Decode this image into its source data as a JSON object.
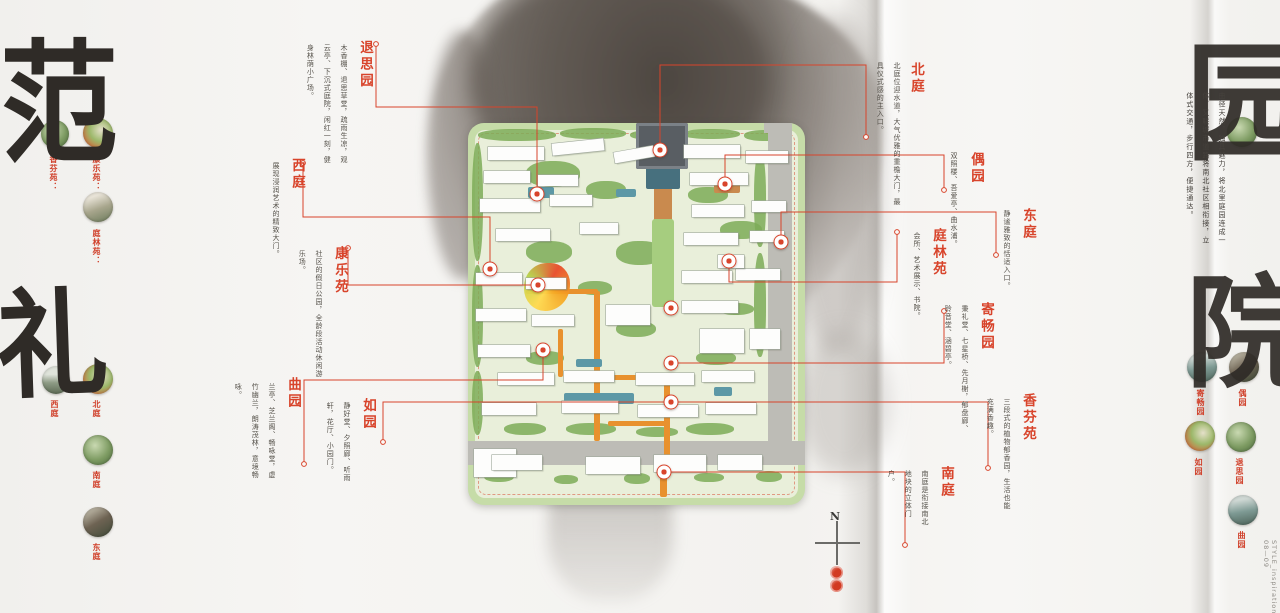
{
  "accent_red": "#d8442b",
  "calligraphy": {
    "top_left": "范",
    "bottom_left": "礼",
    "top_right": "园",
    "bottom_right": "院"
  },
  "right_paragraph": "曲径天然，独具魅力，将北里庭园连成一体，又联城市道路将南北社区相衔接，立体式交通，步行四方，便捷通达。",
  "compass": {
    "label": "N"
  },
  "footer": {
    "brand": "STYLE_inspiration",
    "page_no": "08—09"
  },
  "callouts": [
    {
      "id": "tuisiyuan",
      "title": "退思园",
      "desc": "木香棚、退思草堂，疏雨生凉，观云亭、下沉式庭院，闲红一刻，健身林荫小广场。",
      "title_pos": [
        355,
        40
      ],
      "desc_box": [
        352,
        44,
        120
      ],
      "line": [
        [
          376,
          44
        ],
        [
          376,
          107
        ],
        [
          537,
          107
        ],
        [
          537,
          194
        ]
      ],
      "marker": [
        537,
        194
      ]
    },
    {
      "id": "beiting",
      "title": "北庭",
      "desc": "北庭位迎水道，大气优雅的重檐大门，最具仪式感的主入口。",
      "title_pos": [
        906,
        62
      ],
      "desc_box": [
        905,
        62,
        150
      ],
      "line": [
        [
          866,
          137
        ],
        [
          866,
          65
        ],
        [
          660,
          65
        ],
        [
          660,
          150
        ]
      ],
      "marker": [
        660,
        150
      ]
    },
    {
      "id": "ouyuan",
      "title": "偶园",
      "desc": "双照楼、吾爱亭、曲水浦。",
      "title_pos": [
        966,
        152
      ],
      "desc_box": [
        962,
        152,
        100
      ],
      "line": [
        [
          944,
          190
        ],
        [
          944,
          155
        ],
        [
          725,
          155
        ],
        [
          725,
          184
        ]
      ],
      "marker": [
        725,
        184
      ]
    },
    {
      "id": "dongting",
      "title": "东庭",
      "desc": "静谧雅致的恬适入口。",
      "title_pos": [
        1018,
        208
      ],
      "desc_box": [
        1015,
        210,
        85
      ],
      "line": [
        [
          996,
          255
        ],
        [
          996,
          212
        ],
        [
          781,
          212
        ],
        [
          781,
          242
        ]
      ],
      "marker": [
        781,
        242
      ]
    },
    {
      "id": "tinglinyuan",
      "title": "庭林苑",
      "desc": "会所、艺术展示、书院。",
      "title_pos": [
        928,
        228
      ],
      "desc_box": [
        925,
        232,
        110
      ],
      "line": [
        [
          897,
          232
        ],
        [
          897,
          282
        ],
        [
          729,
          282
        ],
        [
          729,
          261
        ]
      ],
      "marker": [
        729,
        261
      ]
    },
    {
      "id": "xiting",
      "title": "西庭",
      "desc": "展现浸润艺术的精致大门。",
      "title_pos": [
        287,
        158
      ],
      "desc_box": [
        284,
        162,
        100
      ],
      "line": [
        [
          303,
          163
        ],
        [
          303,
          217
        ],
        [
          490,
          217
        ],
        [
          490,
          269
        ]
      ],
      "marker": [
        490,
        269
      ]
    },
    {
      "id": "kangleyuan",
      "title": "康乐苑",
      "desc": "社区的假日公园，全龄段活动休闲游乐场。",
      "title_pos": [
        330,
        246
      ],
      "desc_box": [
        327,
        250,
        135
      ],
      "line": [
        [
          348,
          248
        ],
        [
          348,
          285
        ],
        [
          538,
          285
        ]
      ],
      "marker": [
        538,
        285
      ]
    },
    {
      "id": "jichangyuan",
      "title": "寄畅园",
      "desc": "秉礼堂、七星桥、先月榭，郁盘廊、聆音堂、涵碧亭。",
      "title_pos": [
        976,
        302
      ],
      "desc_box": [
        973,
        305,
        135
      ],
      "line": [
        [
          944,
          311
        ],
        [
          944,
          363
        ],
        [
          671,
          363
        ]
      ],
      "marker": [
        671,
        363
      ]
    },
    {
      "id": "xiangfenyuan",
      "title": "香芬苑",
      "desc": "三段式的植物郁香园，生活也能充满香趣。",
      "title_pos": [
        1018,
        393
      ],
      "desc_box": [
        1015,
        398,
        115
      ],
      "line": [
        [
          988,
          468
        ],
        [
          988,
          402
        ],
        [
          675,
          402
        ]
      ],
      "marker": null
    },
    {
      "id": "quyuan",
      "title": "曲园",
      "desc": "兰亭、芝兰阁、畅咏堂，虚竹幽兰，朗涛茂林，意境畅咏。",
      "title_pos": [
        283,
        377
      ],
      "desc_box": [
        280,
        383,
        100
      ],
      "line": [
        [
          304,
          464
        ],
        [
          304,
          380
        ],
        [
          543,
          380
        ],
        [
          543,
          350
        ]
      ],
      "marker": [
        543,
        350
      ]
    },
    {
      "id": "ruyuan",
      "title": "如园",
      "desc": "静好堂、夕照廊、听雨轩，花厅、小园门。",
      "title_pos": [
        358,
        398
      ],
      "desc_box": [
        355,
        402,
        85
      ],
      "line": [
        [
          383,
          442
        ],
        [
          383,
          402
        ],
        [
          671,
          402
        ]
      ],
      "marker": [
        671,
        402
      ]
    },
    {
      "id": "nanting",
      "title": "南庭",
      "desc": "南庭是衔接南北地块的立体门户。",
      "title_pos": [
        936,
        466
      ],
      "desc_box": [
        933,
        470,
        62
      ],
      "line": [
        [
          905,
          545
        ],
        [
          905,
          472
        ],
        [
          664,
          472
        ]
      ],
      "marker": [
        664,
        472
      ]
    }
  ],
  "extra_markers": [
    [
      671,
      308
    ]
  ],
  "side_thumbs": [
    {
      "cx": 55,
      "cy": 134,
      "r": 14,
      "label": "香芬苑：",
      "lx": 49,
      "ly": 155,
      "p": 0
    },
    {
      "cx": 98,
      "cy": 133,
      "r": 15,
      "label": "康乐苑：",
      "lx": 92,
      "ly": 155,
      "p": 1
    },
    {
      "cx": 98,
      "cy": 207,
      "r": 15,
      "label": "庭林苑：",
      "lx": 92,
      "ly": 229,
      "p": 2
    },
    {
      "cx": 56,
      "cy": 380,
      "r": 14,
      "label": "西庭",
      "lx": 50,
      "ly": 400,
      "p": 3
    },
    {
      "cx": 98,
      "cy": 379,
      "r": 15,
      "label": "北庭",
      "lx": 92,
      "ly": 400,
      "p": 1
    },
    {
      "cx": 98,
      "cy": 450,
      "r": 15,
      "label": "南庭",
      "lx": 92,
      "ly": 471,
      "p": 0
    },
    {
      "cx": 98,
      "cy": 522,
      "r": 15,
      "label": "东庭",
      "lx": 92,
      "ly": 543,
      "p": 4
    },
    {
      "cx": 1242,
      "cy": 132,
      "r": 15,
      "label": "",
      "lx": 0,
      "ly": 0,
      "p": 0
    },
    {
      "cx": 1202,
      "cy": 367,
      "r": 15,
      "label": "寄畅园",
      "lx": 1196,
      "ly": 389,
      "p": 5
    },
    {
      "cx": 1244,
      "cy": 367,
      "r": 15,
      "label": "偶园",
      "lx": 1238,
      "ly": 389,
      "p": 4
    },
    {
      "cx": 1200,
      "cy": 436,
      "r": 15,
      "label": "如园",
      "lx": 1194,
      "ly": 458,
      "p": 1
    },
    {
      "cx": 1241,
      "cy": 437,
      "r": 15,
      "label": "退思园",
      "lx": 1235,
      "ly": 458,
      "p": 0
    },
    {
      "cx": 1243,
      "cy": 510,
      "r": 15,
      "label": "曲园",
      "lx": 1237,
      "ly": 531,
      "p": 5
    }
  ],
  "map": {
    "frame": [
      468,
      123,
      337,
      382
    ],
    "roads": [
      [
        300,
        8,
        24,
        310
      ],
      [
        0,
        318,
        337,
        24
      ],
      [
        296,
        0,
        28,
        10
      ]
    ],
    "greens": [
      [
        10,
        6,
        78,
        12
      ],
      [
        92,
        5,
        66,
        11
      ],
      [
        162,
        7,
        46,
        10
      ],
      [
        214,
        6,
        58,
        10
      ],
      [
        276,
        7,
        42,
        11
      ],
      [
        4,
        20,
        11,
        118
      ],
      [
        4,
        142,
        11,
        102
      ],
      [
        4,
        248,
        11,
        64
      ],
      [
        286,
        28,
        12,
        96
      ],
      [
        286,
        130,
        12,
        104
      ],
      [
        58,
        38,
        54,
        26
      ],
      [
        118,
        58,
        40,
        18
      ],
      [
        58,
        118,
        46,
        22
      ],
      [
        148,
        118,
        48,
        24
      ],
      [
        220,
        64,
        40,
        16
      ],
      [
        252,
        98,
        42,
        18
      ],
      [
        110,
        158,
        34,
        14
      ],
      [
        250,
        180,
        36,
        12
      ],
      [
        148,
        198,
        40,
        16
      ],
      [
        228,
        228,
        40,
        14
      ],
      [
        58,
        228,
        38,
        14
      ],
      [
        36,
        300,
        42,
        12
      ],
      [
        98,
        300,
        50,
        12
      ],
      [
        168,
        304,
        42,
        10
      ],
      [
        218,
        300,
        48,
        12
      ],
      [
        16,
        348,
        30,
        11
      ],
      [
        86,
        352,
        24,
        9
      ],
      [
        156,
        350,
        26,
        11
      ],
      [
        226,
        350,
        30,
        9
      ],
      [
        288,
        348,
        26,
        11
      ]
    ],
    "paths": [
      {
        "r": [
          186,
          50,
          18,
          132
        ],
        "c": "#c98a4e"
      },
      {
        "r": [
          246,
          54,
          26,
          16
        ],
        "c": "#c98a4e"
      },
      {
        "r": [
          126,
          168,
          6,
          150
        ]
      },
      {
        "r": [
          58,
          166,
          72,
          5
        ]
      },
      {
        "r": [
          128,
          252,
          76,
          5
        ]
      },
      {
        "r": [
          196,
          252,
          6,
          94
        ]
      },
      {
        "r": [
          140,
          298,
          58,
          5
        ]
      },
      {
        "r": [
          306,
          114,
          14,
          9
        ]
      },
      {
        "r": [
          192,
          344,
          7,
          30
        ]
      },
      {
        "r": [
          90,
          206,
          5,
          48
        ]
      }
    ],
    "waters": [
      {
        "r": [
          178,
          40,
          34,
          26
        ],
        "c": "#47707e"
      },
      {
        "r": [
          96,
          270,
          70,
          11
        ]
      },
      {
        "r": [
          246,
          264,
          18,
          9
        ]
      },
      {
        "r": [
          60,
          64,
          26,
          11
        ]
      },
      {
        "r": [
          148,
          66,
          20,
          8
        ]
      },
      {
        "r": [
          108,
          236,
          26,
          8
        ]
      }
    ],
    "lawn": [
      184,
      96,
      22,
      88
    ],
    "gate": [
      168,
      0,
      52,
      46
    ],
    "playground": [
      56,
      140,
      46,
      48
    ],
    "buildings": [
      [
        20,
        24,
        56,
        13
      ],
      [
        84,
        18,
        52,
        12,
        -6
      ],
      [
        146,
        26,
        40,
        11,
        -10
      ],
      [
        216,
        22,
        56,
        13
      ],
      [
        278,
        28,
        42,
        12
      ],
      [
        16,
        48,
        46,
        12
      ],
      [
        70,
        52,
        40,
        11
      ],
      [
        222,
        50,
        58,
        12
      ],
      [
        12,
        76,
        60,
        13
      ],
      [
        82,
        72,
        42,
        11
      ],
      [
        224,
        82,
        52,
        12
      ],
      [
        284,
        78,
        34,
        11
      ],
      [
        28,
        106,
        54,
        12
      ],
      [
        112,
        100,
        38,
        11
      ],
      [
        216,
        110,
        54,
        12
      ],
      [
        282,
        108,
        34,
        11
      ],
      [
        8,
        150,
        46,
        12
      ],
      [
        58,
        155,
        40,
        11
      ],
      [
        214,
        148,
        50,
        12
      ],
      [
        268,
        146,
        44,
        11
      ],
      [
        8,
        186,
        50,
        12
      ],
      [
        64,
        192,
        42,
        11
      ],
      [
        214,
        178,
        56,
        12
      ],
      [
        138,
        182,
        44,
        20
      ],
      [
        232,
        206,
        44,
        24
      ],
      [
        282,
        206,
        30,
        20
      ],
      [
        250,
        132,
        26,
        13
      ],
      [
        10,
        222,
        52,
        12
      ],
      [
        30,
        250,
        56,
        12
      ],
      [
        96,
        248,
        50,
        11
      ],
      [
        168,
        250,
        58,
        12
      ],
      [
        234,
        248,
        52,
        11
      ],
      [
        14,
        280,
        54,
        12
      ],
      [
        94,
        278,
        56,
        12
      ],
      [
        170,
        282,
        60,
        12
      ],
      [
        238,
        280,
        50,
        11
      ],
      [
        6,
        326,
        42,
        28
      ],
      [
        24,
        332,
        50,
        15
      ],
      [
        118,
        334,
        54,
        17
      ],
      [
        186,
        332,
        52,
        17
      ],
      [
        250,
        332,
        44,
        15
      ]
    ]
  }
}
